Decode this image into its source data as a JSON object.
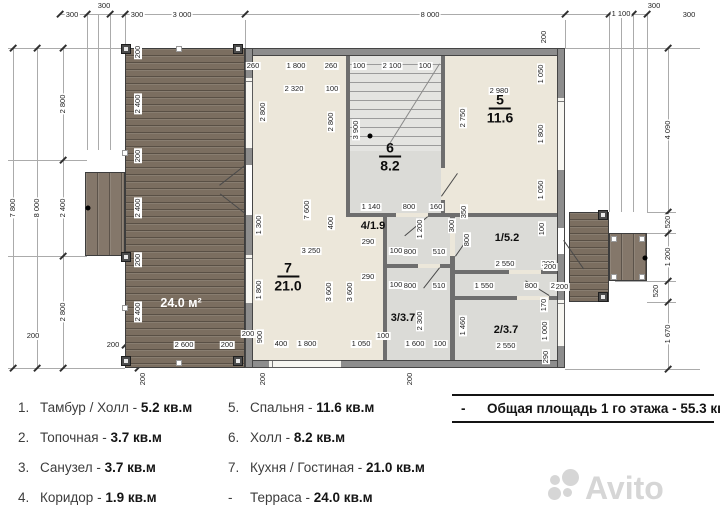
{
  "plan": {
    "terrace_label": "24.0 м²",
    "rooms_stacked": [
      {
        "name": "kitchen-living",
        "num": "7",
        "area": "21.0",
        "x": 288,
        "y": 277
      },
      {
        "name": "hall",
        "num": "6",
        "area": "8.2",
        "x": 390,
        "y": 157
      },
      {
        "name": "bedroom",
        "num": "5",
        "area": "11.6",
        "x": 500,
        "y": 109
      }
    ],
    "rooms_inline": [
      {
        "name": "corridor",
        "label": "4/1.9",
        "x": 373,
        "y": 226
      },
      {
        "name": "tambour-hall",
        "label": "1/5.2",
        "x": 507,
        "y": 238
      },
      {
        "name": "bathroom",
        "label": "3/3.7",
        "x": 403,
        "y": 318
      },
      {
        "name": "boiler-room",
        "label": "2/3.7",
        "x": 506,
        "y": 330
      }
    ],
    "dims": [
      [
        "300",
        72,
        15,
        0
      ],
      [
        "300",
        104,
        6,
        0
      ],
      [
        "300",
        137,
        15,
        0
      ],
      [
        "3 000",
        182,
        15,
        0
      ],
      [
        "8 000",
        430,
        15,
        0
      ],
      [
        "1 100",
        621,
        14,
        0
      ],
      [
        "300",
        654,
        6,
        0
      ],
      [
        "300",
        689,
        15,
        0
      ],
      [
        "7 800",
        13,
        208,
        1
      ],
      [
        "8 000",
        37,
        208,
        1
      ],
      [
        "2 800",
        63,
        104,
        1
      ],
      [
        "2 400",
        63,
        208,
        1
      ],
      [
        "2 800",
        63,
        312,
        1
      ],
      [
        "200",
        33,
        336,
        0
      ],
      [
        "4 090",
        668,
        130,
        1
      ],
      [
        "520",
        668,
        222,
        1
      ],
      [
        "1 200",
        668,
        257,
        1
      ],
      [
        "520",
        656,
        291,
        1
      ],
      [
        "1 670",
        668,
        334,
        1
      ],
      [
        "200",
        138,
        52,
        1
      ],
      [
        "2 400",
        138,
        104,
        1
      ],
      [
        "200",
        138,
        156,
        1
      ],
      [
        "2 400",
        138,
        208,
        1
      ],
      [
        "200",
        138,
        260,
        1
      ],
      [
        "2 400",
        138,
        312,
        1
      ],
      [
        "200",
        113,
        345,
        0
      ],
      [
        "2 600",
        184,
        345,
        0
      ],
      [
        "200",
        227,
        345,
        0
      ],
      [
        "200",
        143,
        379,
        1
      ],
      [
        "200",
        263,
        379,
        1
      ],
      [
        "200",
        410,
        379,
        1
      ],
      [
        "260",
        253,
        66,
        0
      ],
      [
        "1 800",
        296,
        66,
        0
      ],
      [
        "260",
        331,
        66,
        0
      ],
      [
        "100",
        359,
        66,
        0
      ],
      [
        "2 100",
        392,
        66,
        0
      ],
      [
        "100",
        425,
        66,
        0
      ],
      [
        "2 320",
        294,
        89,
        0
      ],
      [
        "100",
        332,
        89,
        0
      ],
      [
        "2 980",
        499,
        91,
        0
      ],
      [
        "200",
        544,
        37,
        1
      ],
      [
        "1 050",
        541,
        74,
        1
      ],
      [
        "1 800",
        541,
        134,
        1
      ],
      [
        "1 050",
        541,
        190,
        1
      ],
      [
        "2 800",
        263,
        112,
        1
      ],
      [
        "2 800",
        331,
        122,
        1
      ],
      [
        "3 900",
        356,
        130,
        1
      ],
      [
        "2 750",
        463,
        118,
        1
      ],
      [
        "1 140",
        371,
        207,
        0
      ],
      [
        "800",
        409,
        207,
        0
      ],
      [
        "160",
        436,
        207,
        0
      ],
      [
        "1 300",
        259,
        225,
        1
      ],
      [
        "1 800",
        259,
        290,
        1
      ],
      [
        "900",
        260,
        337,
        1
      ],
      [
        "7 600",
        307,
        210,
        1
      ],
      [
        "400",
        331,
        223,
        1
      ],
      [
        "3 250",
        311,
        251,
        0
      ],
      [
        "3 600",
        329,
        292,
        1
      ],
      [
        "3 600",
        350,
        292,
        1
      ],
      [
        "100",
        396,
        251,
        0
      ],
      [
        "100",
        396,
        285,
        0
      ],
      [
        "290",
        368,
        242,
        0
      ],
      [
        "800",
        410,
        252,
        0
      ],
      [
        "510",
        439,
        252,
        0
      ],
      [
        "290",
        368,
        277,
        0
      ],
      [
        "800",
        410,
        286,
        0
      ],
      [
        "510",
        439,
        286,
        0
      ],
      [
        "1 200",
        420,
        229,
        1
      ],
      [
        "350",
        464,
        212,
        1
      ],
      [
        "300",
        452,
        226,
        1
      ],
      [
        "800",
        467,
        240,
        1
      ],
      [
        "100",
        542,
        229,
        1
      ],
      [
        "2 550",
        505,
        264,
        0
      ],
      [
        "200",
        548,
        264,
        0
      ],
      [
        "1 550",
        484,
        286,
        0
      ],
      [
        "800",
        531,
        286,
        0
      ],
      [
        "200",
        557,
        286,
        0
      ],
      [
        "2 300",
        420,
        321,
        1
      ],
      [
        "1 460",
        463,
        326,
        1
      ],
      [
        "170",
        544,
        305,
        1
      ],
      [
        "1 000",
        545,
        331,
        1
      ],
      [
        "290",
        546,
        357,
        1
      ],
      [
        "2 550",
        506,
        346,
        0
      ],
      [
        "200",
        248,
        334,
        0
      ],
      [
        "400",
        281,
        344,
        0
      ],
      [
        "1 800",
        307,
        344,
        0
      ],
      [
        "1 050",
        361,
        344,
        0
      ],
      [
        "100",
        383,
        336,
        0
      ],
      [
        "1 600",
        415,
        344,
        0
      ],
      [
        "100",
        440,
        344,
        0
      ],
      [
        "200",
        550,
        267,
        0
      ],
      [
        "200",
        562,
        287,
        0
      ]
    ]
  },
  "legend": {
    "left": [
      {
        "num": "1.",
        "name": "Тамбур / Холл",
        "value": "5.2 кв.м"
      },
      {
        "num": "2.",
        "name": "Топочная",
        "value": "3.7 кв.м"
      },
      {
        "num": "3.",
        "name": "Санузел",
        "value": "3.7 кв.м"
      },
      {
        "num": "4.",
        "name": "Коридор",
        "value": "1.9 кв.м"
      }
    ],
    "right": [
      {
        "num": "5.",
        "name": "Спальня",
        "value": "11.6 кв.м"
      },
      {
        "num": "6.",
        "name": "Холл",
        "value": "8.2 кв.м"
      },
      {
        "num": "7.",
        "name": "Кухня / Гостиная",
        "value": "21.0 кв.м"
      },
      {
        "num": "-",
        "name": "Терраса",
        "value": "24.0 кв.м"
      }
    ],
    "total_dash": "-",
    "total_name": "Общая площадь 1 го этажа",
    "total_value": "55.3 кв.м"
  },
  "watermark": {
    "text": "Avito"
  },
  "colors": {
    "floor_cream": "#ece7da",
    "room_gray": "#dbdbd7",
    "wall": "#8d8d8d",
    "wood": "#7b6e60",
    "watermark_gray": "#d6d6d6"
  }
}
